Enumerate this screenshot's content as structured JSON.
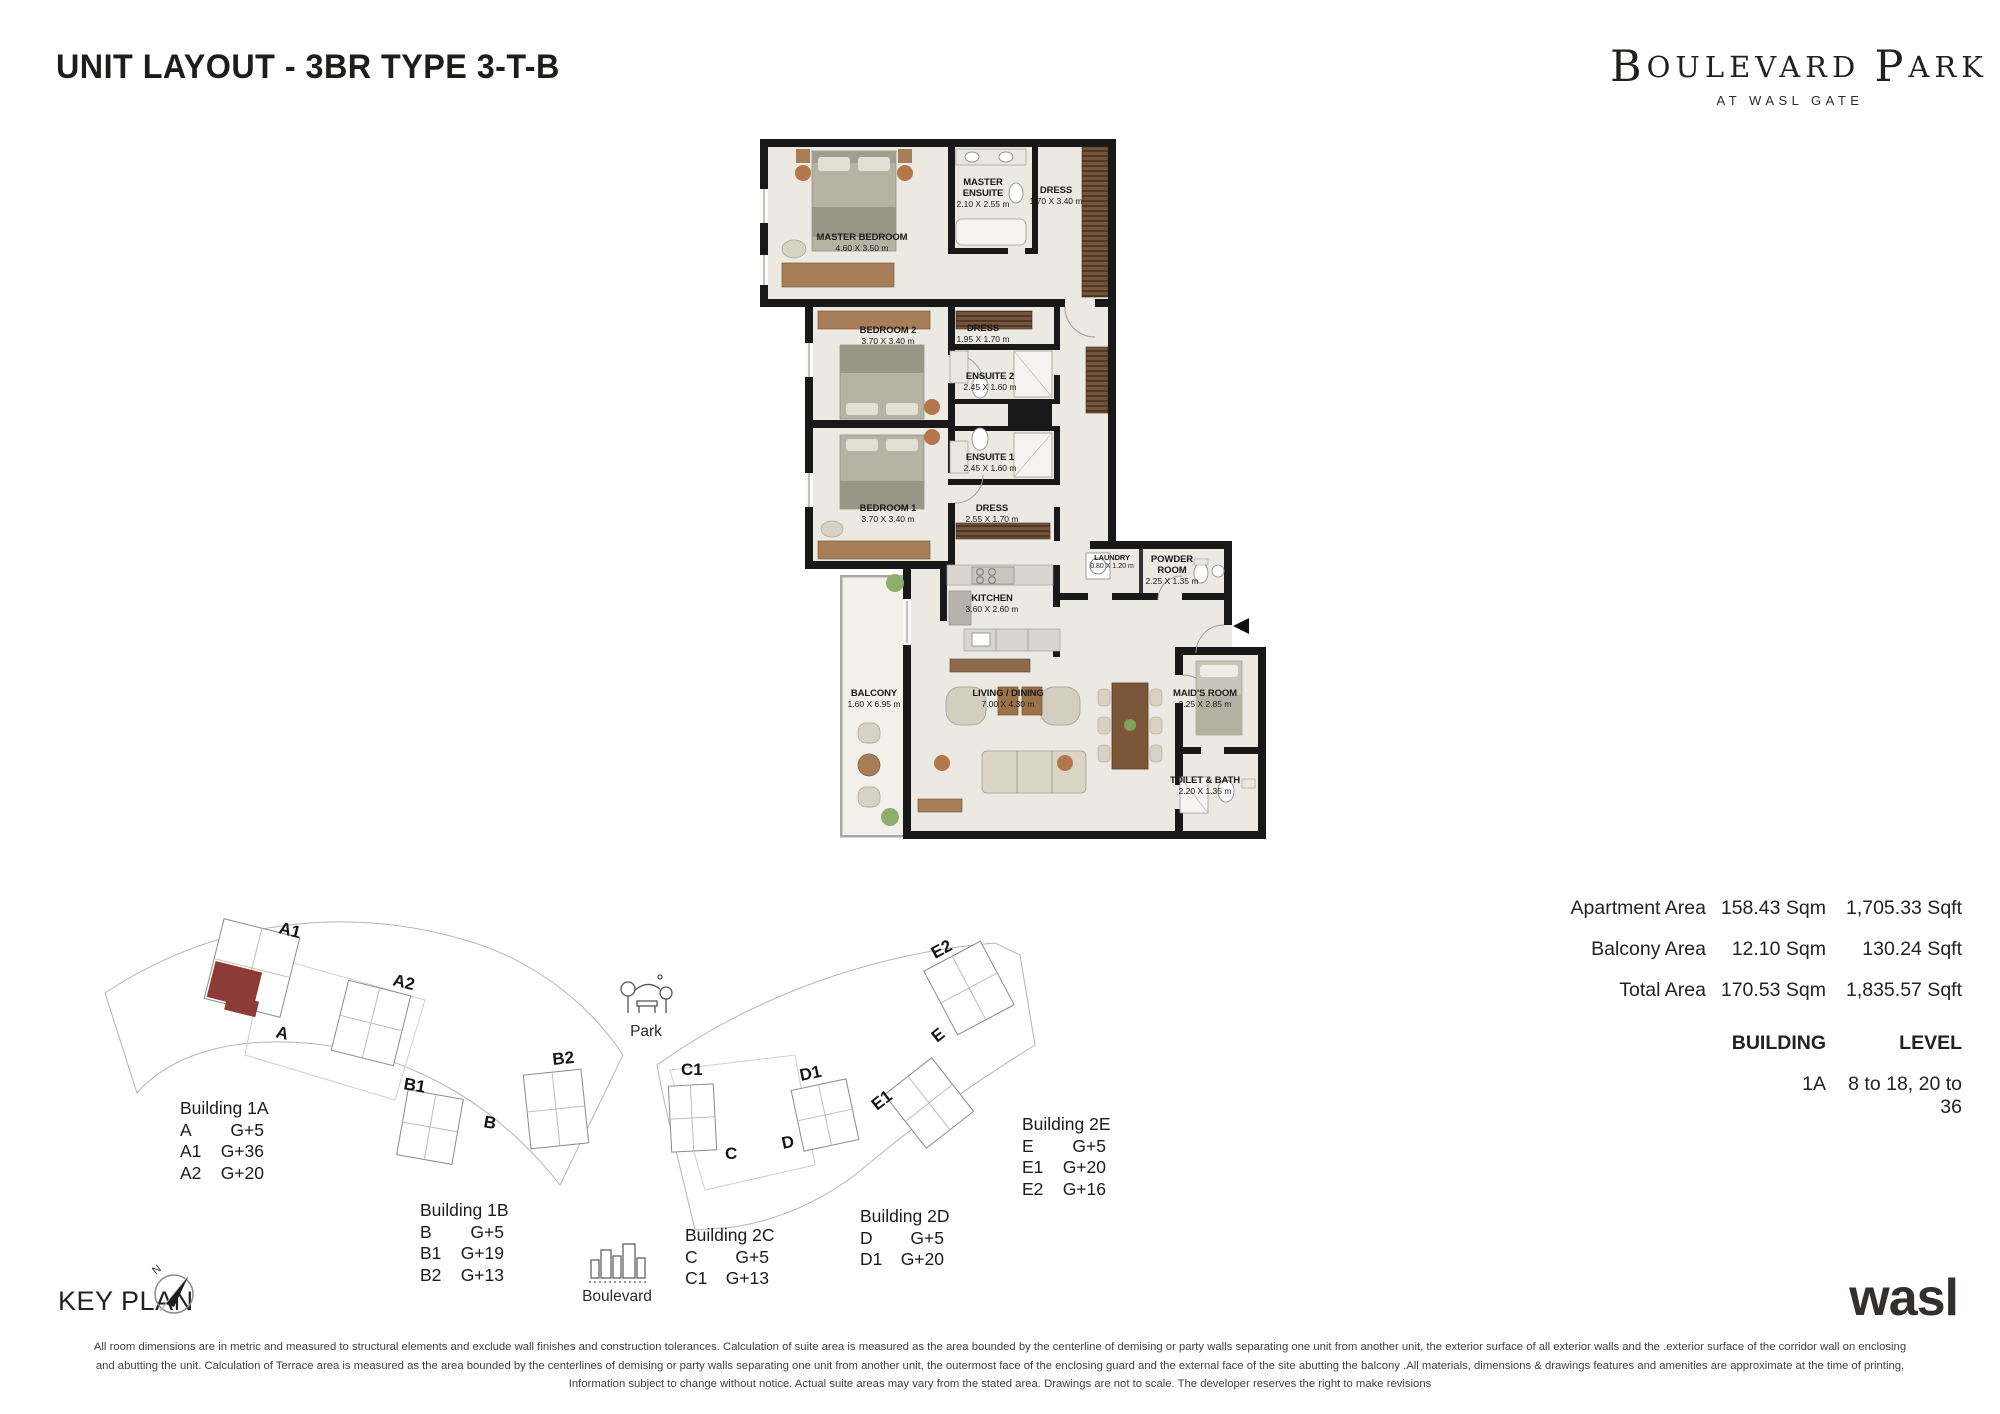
{
  "page": {
    "title": "UNIT LAYOUT - 3BR TYPE 3-T-B",
    "brand": {
      "b1": "B",
      "rest1": "OULEVARD",
      "b2": "P",
      "rest2": "ARK",
      "sub": "AT WASL GATE"
    },
    "developer_logo": "wasl",
    "key_plan_title": "KEY PLAN"
  },
  "floor_plan": {
    "entry_arrow": "entry",
    "rooms": [
      {
        "name": "MASTER BEDROOM",
        "dims": "4.60 X 3.50 m"
      },
      {
        "name": "MASTER ENSUITE",
        "dims": "2.10 X 2.55 m"
      },
      {
        "name": "DRESS",
        "dims": "1.70 X 3.40 m"
      },
      {
        "name": "BEDROOM 2",
        "dims": "3.70 X 3.40 m"
      },
      {
        "name": "DRESS",
        "dims": "1.95 X 1.70 m"
      },
      {
        "name": "ENSUITE 2",
        "dims": "2.45 X 1.60 m"
      },
      {
        "name": "ENSUITE 1",
        "dims": "2.45 X 1.60 m"
      },
      {
        "name": "BEDROOM 1",
        "dims": "3.70 X 3.40 m"
      },
      {
        "name": "DRESS",
        "dims": "2.55 X 1.70 m"
      },
      {
        "name": "KITCHEN",
        "dims": "3.60 X 2.60 m"
      },
      {
        "name": "LAUNDRY",
        "dims": "0.80 X 1.20 m"
      },
      {
        "name": "POWDER ROOM",
        "dims": "2.25 X 1.35 m"
      },
      {
        "name": "BALCONY",
        "dims": "1.60 X 6.95 m"
      },
      {
        "name": "LIVING / DINING",
        "dims": "7.00 X 4.30 m"
      },
      {
        "name": "MAID'S ROOM",
        "dims": "2.25 X 2.85 m"
      },
      {
        "name": "TOILET & BATH",
        "dims": "2.20 X 1.35 m"
      }
    ]
  },
  "areas": {
    "rows": [
      {
        "label": "Apartment Area",
        "sqm": "158.43 Sqm",
        "sqft": "1,705.33 Sqft"
      },
      {
        "label": "Balcony Area",
        "sqm": "12.10 Sqm",
        "sqft": "130.24 Sqft"
      },
      {
        "label": "Total Area",
        "sqm": "170.53 Sqm",
        "sqft": "1,835.57 Sqft"
      }
    ],
    "building_header": "BUILDING",
    "level_header": "LEVEL",
    "building": "1A",
    "level": "8 to 18, 20 to 36"
  },
  "key_plan": {
    "compass_n": "N",
    "park_label": "Park",
    "boulevard_label": "Boulevard",
    "building_labels": [
      "A1",
      "A2",
      "A",
      "B1",
      "B",
      "B2",
      "C1",
      "C",
      "D1",
      "D",
      "E1",
      "E",
      "E2"
    ],
    "highlight_color": "#8d3b36",
    "legend": [
      {
        "title": "Building 1A",
        "rows": [
          {
            "u": "A",
            "v": "G+5"
          },
          {
            "u": "A1",
            "v": "G+36"
          },
          {
            "u": "A2",
            "v": "G+20"
          }
        ]
      },
      {
        "title": "Building 1B",
        "rows": [
          {
            "u": "B",
            "v": "G+5"
          },
          {
            "u": "B1",
            "v": "G+19"
          },
          {
            "u": "B2",
            "v": "G+13"
          }
        ]
      },
      {
        "title": "Building 2C",
        "rows": [
          {
            "u": "C",
            "v": "G+5"
          },
          {
            "u": "C1",
            "v": "G+13"
          }
        ]
      },
      {
        "title": "Building 2D",
        "rows": [
          {
            "u": "D",
            "v": "G+5"
          },
          {
            "u": "D1",
            "v": "G+20"
          }
        ]
      },
      {
        "title": "Building 2E",
        "rows": [
          {
            "u": "E",
            "v": "G+5"
          },
          {
            "u": "E1",
            "v": "G+20"
          },
          {
            "u": "E2",
            "v": "G+16"
          }
        ]
      }
    ]
  },
  "disclaimer": {
    "line1": "All room dimensions are in metric and measured to structural elements and exclude wall finishes and construction tolerances. Calculation of suite area is measured as the area bounded by the centerline of demising or party walls separating one unit from another unit, the exterior surface of all exterior walls and the .exterior surface of the corridor wall on enclosing",
    "line2": "and abutting the unit. Calculation of Terrace area is measured as the area bounded by the centerlines of demising or party walls separating one unit from another unit, the outermost face of the enclosing guard and the external face of the site abutting the balcony .All materials, dimensions & drawings features and amenities are approximate at the time of printing,",
    "line3": "Information subject to change without notice. Actual suite areas may vary from the stated area. Drawings are not to scale. The developer reserves the right to make revisions"
  }
}
